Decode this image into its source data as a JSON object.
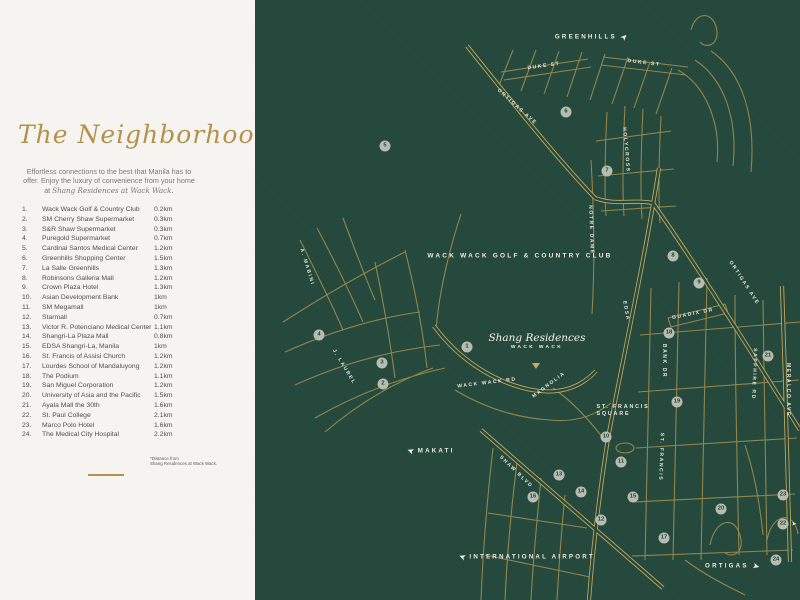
{
  "panel": {
    "title": "The Neighborhood",
    "intro_plain": "Effortless connections to the best that Manila has to offer. Enjoy the luxury of convenience from your home at ",
    "intro_italic": "Shang Residences at Wack Wack.",
    "footnote_line1": "*Distance from",
    "footnote_line2": "Shang Residences at Wack Wack.",
    "places": [
      {
        "no": "1.",
        "name": "Wack Wack Golf & Country Club",
        "dist": "0.2km"
      },
      {
        "no": "2.",
        "name": "SM Cherry Shaw Supermarket",
        "dist": "0.3km"
      },
      {
        "no": "3.",
        "name": "S&R Shaw Supermarket",
        "dist": "0.3km"
      },
      {
        "no": "4.",
        "name": "Puregold Supermarket",
        "dist": "0.7km"
      },
      {
        "no": "5.",
        "name": "Cardinal Santos Medical Center",
        "dist": "1.2km"
      },
      {
        "no": "6.",
        "name": "Greenhills Shopping Center",
        "dist": "1.5km"
      },
      {
        "no": "7.",
        "name": "La Salle Greenhills",
        "dist": "1.3km"
      },
      {
        "no": "8.",
        "name": "Robinsons Galleria Mall",
        "dist": "1.2km"
      },
      {
        "no": "9.",
        "name": "Crown Plaza Hotel",
        "dist": "1.3km"
      },
      {
        "no": "10.",
        "name": "Asian Development Bank",
        "dist": "1km"
      },
      {
        "no": "11.",
        "name": "SM Megamall",
        "dist": "1km"
      },
      {
        "no": "12.",
        "name": "Starmall",
        "dist": "0.7km"
      },
      {
        "no": "13.",
        "name": "Victor R. Potenciano Medical Center",
        "dist": "1.1km"
      },
      {
        "no": "14.",
        "name": "Shangri-La Plaza Mall",
        "dist": "0.8km"
      },
      {
        "no": "15.",
        "name": "EDSA Shangri-La, Manila",
        "dist": "1km"
      },
      {
        "no": "16.",
        "name": "St. Francis of Assisi Church",
        "dist": "1.2km"
      },
      {
        "no": "17.",
        "name": "Lourdes School of Mandaluyong",
        "dist": "1.2km"
      },
      {
        "no": "18.",
        "name": "The Podium",
        "dist": "1.1km"
      },
      {
        "no": "19.",
        "name": "San Miguel Corporation",
        "dist": "1.2km"
      },
      {
        "no": "20.",
        "name": "University of Asia and the Pacific",
        "dist": "1.5km"
      },
      {
        "no": "21.",
        "name": "Ayala Mall the 30th",
        "dist": "1.6km"
      },
      {
        "no": "22.",
        "name": "St. Paul College",
        "dist": "2.1km"
      },
      {
        "no": "23.",
        "name": "Marco Polo Hotel",
        "dist": "1.6km"
      },
      {
        "no": "24.",
        "name": "The Medical City Hospital",
        "dist": "2.2km"
      }
    ]
  },
  "map": {
    "colors": {
      "background": "#24483b",
      "road_gold": "#a08c4d",
      "road_gold_bright": "#c2a65a",
      "label_white": "#ece9e0",
      "accent_gold": "#b5924c"
    },
    "club_label": "WACK WACK GOLF & COUNTRY CLUB",
    "residence_script": "Shang Residences",
    "residence_caps": "WACK WACK",
    "area_label": {
      "line1": "ST. FRANCIS",
      "line2": "SQUARE",
      "x": 368,
      "y": 411
    },
    "street_labels": [
      {
        "text": "DUKE ST",
        "x": 289,
        "y": 66,
        "rot": -8
      },
      {
        "text": "DUKE ST",
        "x": 389,
        "y": 63,
        "rot": 7
      },
      {
        "text": "ORTIGAS AVE",
        "x": 262,
        "y": 107,
        "rot": 42
      },
      {
        "text": "ORTIGAS AVE",
        "x": 489,
        "y": 283,
        "rot": 57
      },
      {
        "text": "HOLYCROSS",
        "x": 371,
        "y": 150,
        "rot": 85
      },
      {
        "text": "NOTRE DAME",
        "x": 336,
        "y": 230,
        "rot": 88
      },
      {
        "text": "EDSA",
        "x": 371,
        "y": 311,
        "rot": 80
      },
      {
        "text": "GUADIX DR",
        "x": 438,
        "y": 314,
        "rot": -11
      },
      {
        "text": "BANK DR",
        "x": 409,
        "y": 361,
        "rot": 90
      },
      {
        "text": "SAPPHIRE RD",
        "x": 499,
        "y": 374,
        "rot": 92
      },
      {
        "text": "MERALCO AVE",
        "x": 533,
        "y": 390,
        "rot": 90
      },
      {
        "text": "ST. FRANCIS",
        "x": 406,
        "y": 457,
        "rot": 92
      },
      {
        "text": "WACK WACK RD",
        "x": 232,
        "y": 383,
        "rot": -7
      },
      {
        "text": "MAGNOLIA",
        "x": 294,
        "y": 385,
        "rot": -37
      },
      {
        "text": "SHAW BLVD",
        "x": 261,
        "y": 472,
        "rot": 44
      },
      {
        "text": "A. MABINI",
        "x": 52,
        "y": 267,
        "rot": 73
      },
      {
        "text": "J. LAUREL",
        "x": 89,
        "y": 367,
        "rot": 59
      }
    ],
    "directions": [
      {
        "text": "GREENHILLS",
        "x": 336,
        "y": 37,
        "side": "right",
        "rot": -45
      },
      {
        "text": "MAKATI",
        "x": 176,
        "y": 451,
        "side": "left",
        "rot": 200
      },
      {
        "text": "INTERNATIONAL AIRPORT",
        "x": 272,
        "y": 557,
        "side": "left",
        "rot": 200
      },
      {
        "text": "ORTIGAS",
        "x": 477,
        "y": 566,
        "side": "right",
        "rot": 15
      }
    ],
    "markers": [
      {
        "n": "1",
        "x": 212,
        "y": 347
      },
      {
        "n": "2",
        "x": 128,
        "y": 384
      },
      {
        "n": "3",
        "x": 127,
        "y": 363
      },
      {
        "n": "4",
        "x": 64,
        "y": 335
      },
      {
        "n": "5",
        "x": 130,
        "y": 146
      },
      {
        "n": "6",
        "x": 311,
        "y": 112
      },
      {
        "n": "7",
        "x": 352,
        "y": 171
      },
      {
        "n": "8",
        "x": 418,
        "y": 256
      },
      {
        "n": "9",
        "x": 444,
        "y": 283
      },
      {
        "n": "10",
        "x": 351,
        "y": 437
      },
      {
        "n": "11",
        "x": 366,
        "y": 462
      },
      {
        "n": "12",
        "x": 346,
        "y": 520
      },
      {
        "n": "13",
        "x": 304,
        "y": 475
      },
      {
        "n": "14",
        "x": 326,
        "y": 492
      },
      {
        "n": "15",
        "x": 378,
        "y": 497
      },
      {
        "n": "16",
        "x": 278,
        "y": 497
      },
      {
        "n": "17",
        "x": 409,
        "y": 538
      },
      {
        "n": "18",
        "x": 414,
        "y": 333
      },
      {
        "n": "19",
        "x": 422,
        "y": 402
      },
      {
        "n": "20",
        "x": 466,
        "y": 509
      },
      {
        "n": "21",
        "x": 513,
        "y": 356
      },
      {
        "n": "22",
        "x": 528,
        "y": 524,
        "arrow": true
      },
      {
        "n": "23",
        "x": 528,
        "y": 495
      },
      {
        "n": "24",
        "x": 521,
        "y": 560
      }
    ]
  }
}
